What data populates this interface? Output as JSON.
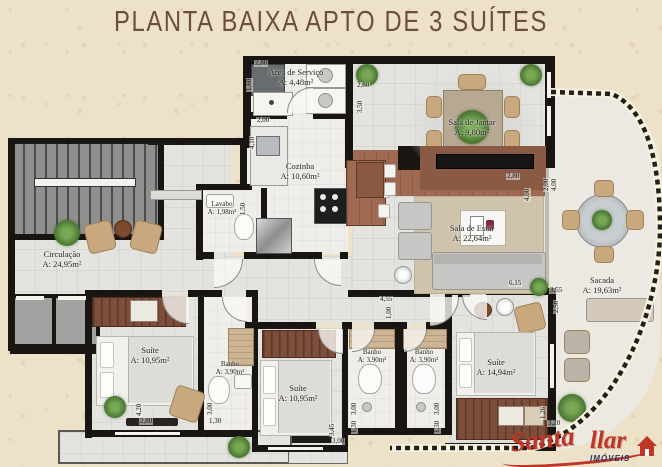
{
  "title": "PLANTA BAIXA APTO DE 3 SUÍTES",
  "rooms": {
    "circulacao": {
      "name": "Circulação",
      "area": "A: 24,95m²"
    },
    "area_servico": {
      "name": "Área de Serviço",
      "area": "A: 4,48m²"
    },
    "cozinha": {
      "name": "Cozinha",
      "area": "A: 10,60m²"
    },
    "lavabo": {
      "name": "Lavabo",
      "area": "A: 1,98m²"
    },
    "sala_jantar": {
      "name": "Sala de Jantar",
      "area": "A: 9,80m²"
    },
    "sala_estar": {
      "name": "Sala de Estar",
      "area": "A: 22,64m²"
    },
    "sacada": {
      "name": "Sacada",
      "area": "A: 19,63m²"
    },
    "suite_1": {
      "name": "Suíte",
      "area": "A: 10,95m²"
    },
    "banho_1": {
      "name": "Banho",
      "area": "A: 3,90m²"
    },
    "suite_2": {
      "name": "Suíte",
      "area": "A: 10,95m²"
    },
    "banho_2": {
      "name": "Banho",
      "area": "A: 3,90m²"
    },
    "banho_3": {
      "name": "Banho",
      "area": "A: 3,90m²"
    },
    "suite_3": {
      "name": "Suíte",
      "area": "A: 14,94m²"
    }
  },
  "dims": {
    "servico": {
      "w": "2,80",
      "h": "1,60"
    },
    "cozinha": {
      "w": "2,00",
      "h": "4,10"
    },
    "jantar": {
      "w": "2,80",
      "h": "3,50"
    },
    "estar": {
      "w": "2,80",
      "h": "4,00",
      "len": "6,15"
    },
    "sacada": {
      "w": "2,00",
      "h": "4,00"
    },
    "sacada_low": {
      "w": "3,55",
      "h": "2,50"
    },
    "hall": {
      "w": "4,55",
      "h": "1,00"
    },
    "lavabo": {
      "h": "1,50"
    },
    "suite1": {
      "w": "2,80",
      "h": "4,20"
    },
    "suite2": {
      "w": "3,00",
      "h": "3,45"
    },
    "suite3": {
      "w": "3,20",
      "h": "1,26"
    },
    "banho1": {
      "w": "1,30",
      "h": "3,00"
    },
    "banho2": {
      "w": "1,30",
      "h": "3,00"
    },
    "banho3": {
      "w": "1,30",
      "h": "3,00"
    }
  },
  "logo": {
    "brand_a": "Santa",
    "brand_b": "llar",
    "subtitle": "IMÓVEIS"
  }
}
